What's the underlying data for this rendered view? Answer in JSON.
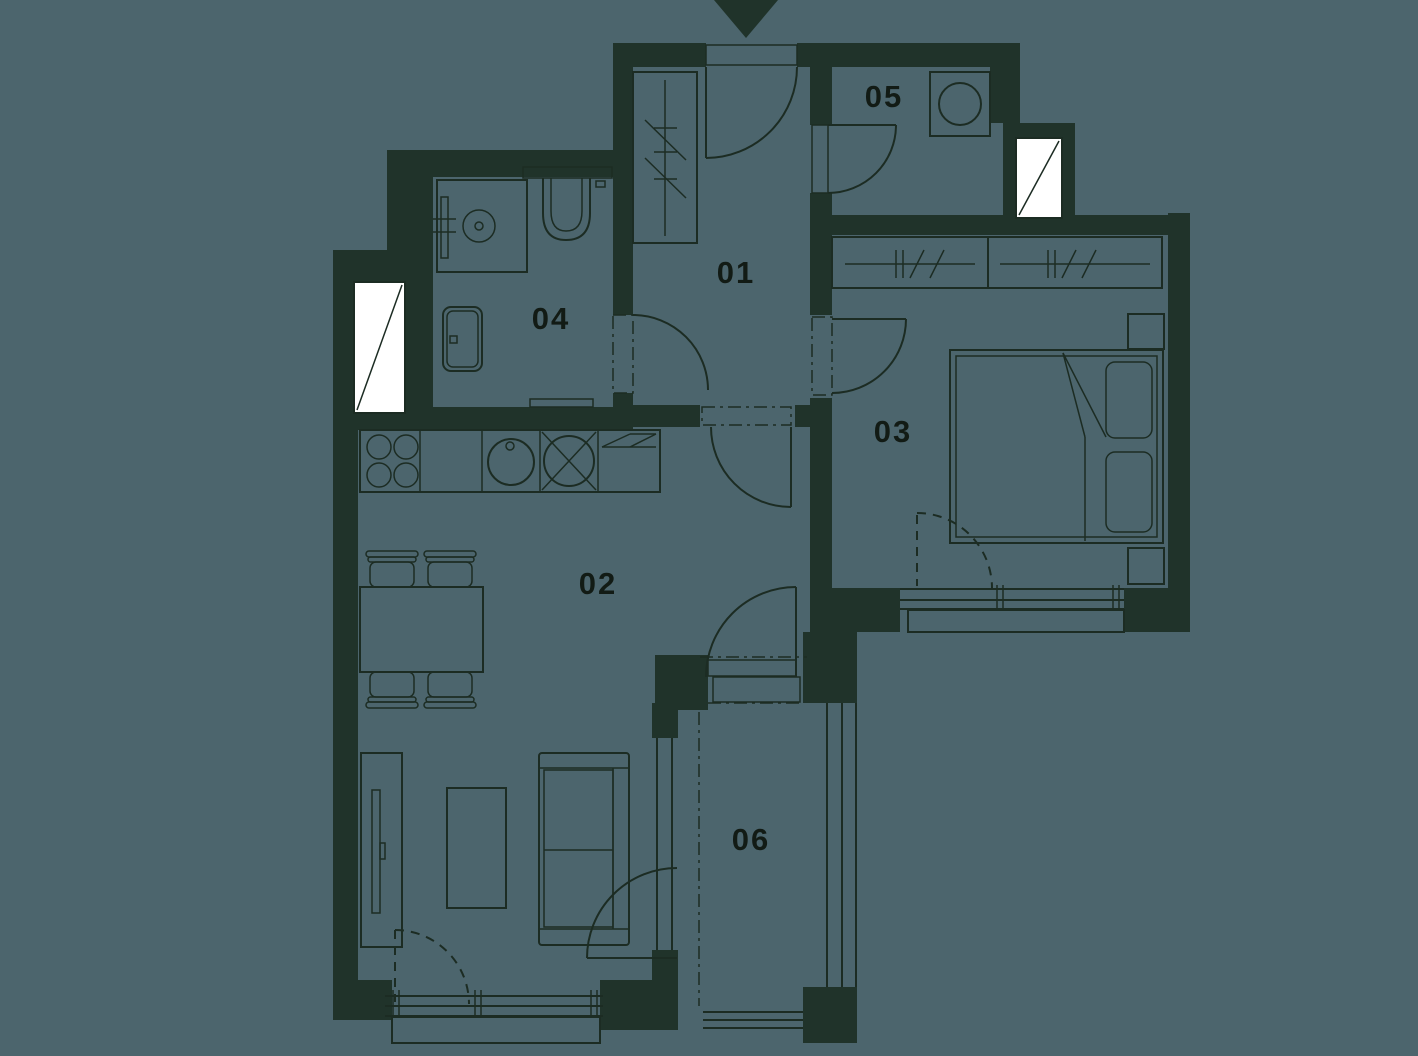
{
  "floorplan": {
    "colors": {
      "background": "#4c656d",
      "wall": "#20332a",
      "line": "#1c2c23",
      "label": "#121b15",
      "window": "#ffffff"
    },
    "rooms": [
      {
        "id": "room-01",
        "label": "01"
      },
      {
        "id": "room-02",
        "label": "02"
      },
      {
        "id": "room-03",
        "label": "03"
      },
      {
        "id": "room-04",
        "label": "04"
      },
      {
        "id": "room-05",
        "label": "05"
      },
      {
        "id": "room-06",
        "label": "06"
      }
    ]
  }
}
